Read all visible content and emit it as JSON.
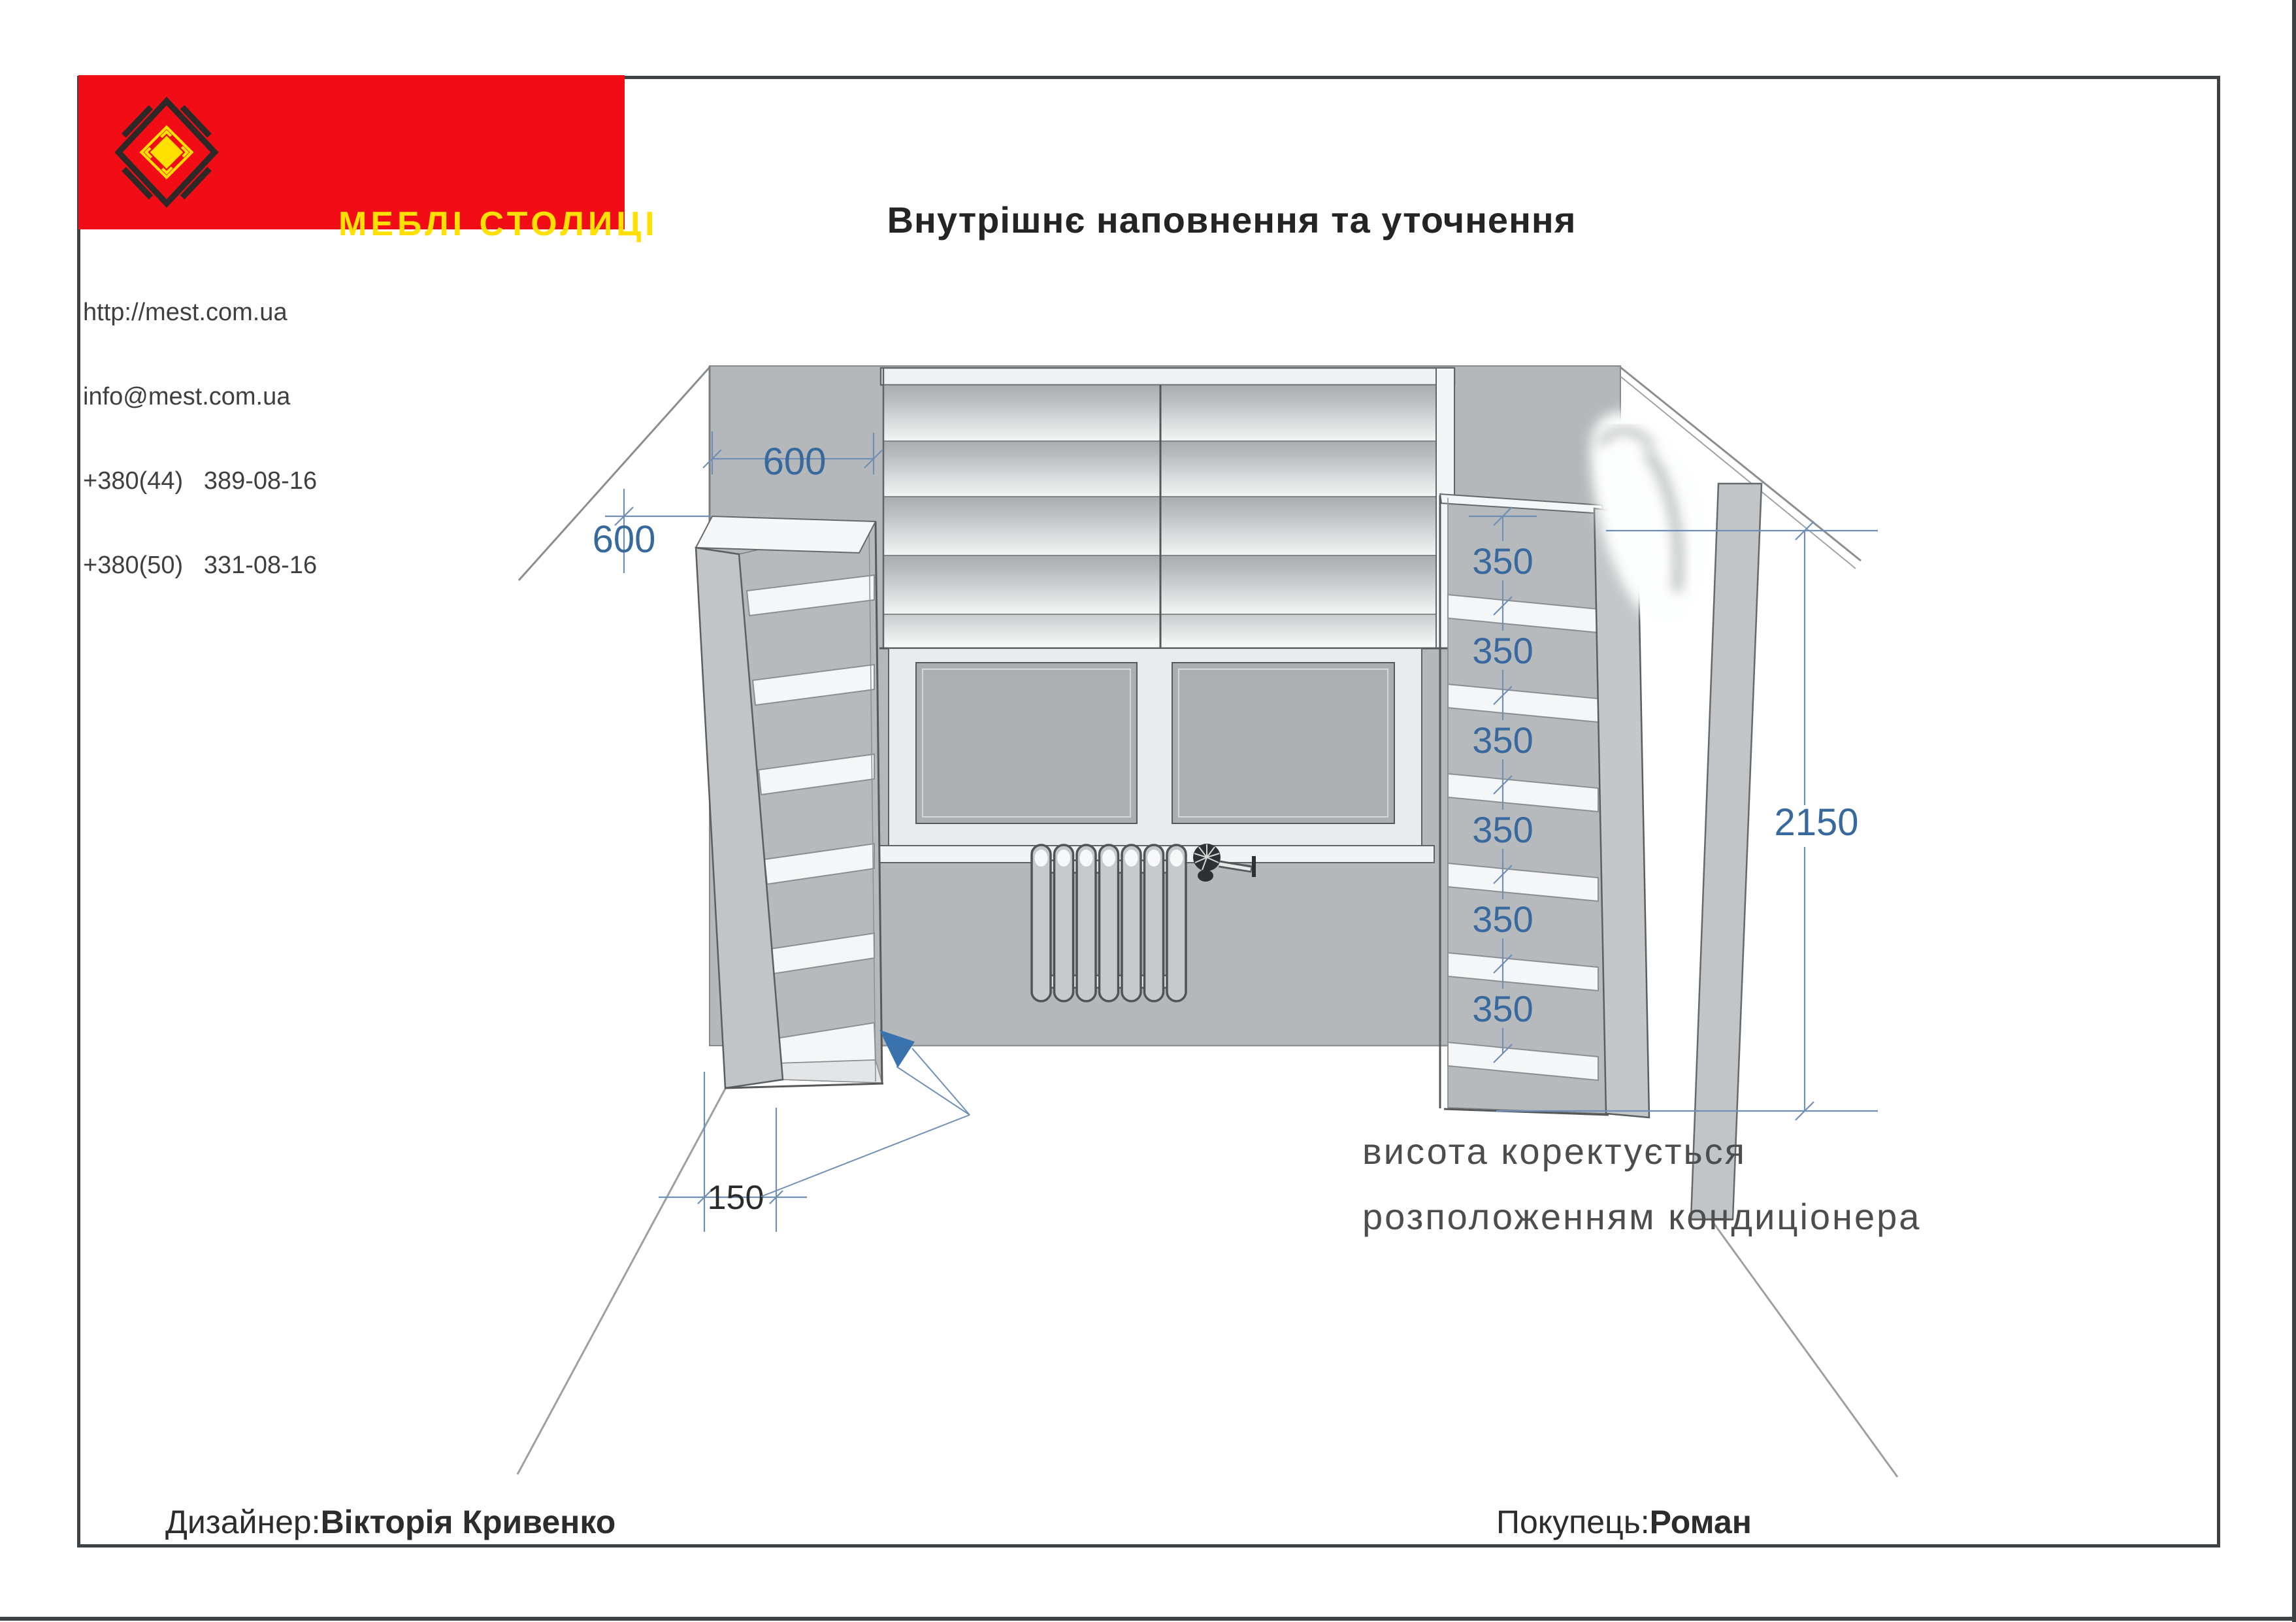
{
  "title": "Внутрішнє наповнення та уточнення",
  "company": {
    "logo_text": "МЕБЛІ СТОЛИЦІ",
    "website": "http://mest.com.ua",
    "email": "info@mest.com.ua",
    "phone_kyiv": "+380(44)   389-08-16",
    "phone_mobile": "+380(50)   331-08-16"
  },
  "drawing": {
    "dimensions": {
      "niche_width": "600",
      "niche_height": "600",
      "shelf_gaps": [
        "350",
        "350",
        "350",
        "350",
        "350",
        "350"
      ],
      "total_height": "2150",
      "plinth_offset": "150"
    },
    "note_line1": "висота коректується",
    "note_line2": "розположенням кондиціонера"
  },
  "footer": {
    "designer_label": "Дизайнер:",
    "designer_name": "Вікторія Кривенко",
    "customer_label": "Покупець:",
    "customer_name": "Роман"
  },
  "colors": {
    "brand_red": "#f20d16",
    "brand_yellow": "#ffe000",
    "logo_black": "#2e2929",
    "dimension_text_blue": "#38699e",
    "dimension_line_blue": "#6f8fb6",
    "wall_gray": "#b5b8ba",
    "border_dark": "#3f4245"
  }
}
